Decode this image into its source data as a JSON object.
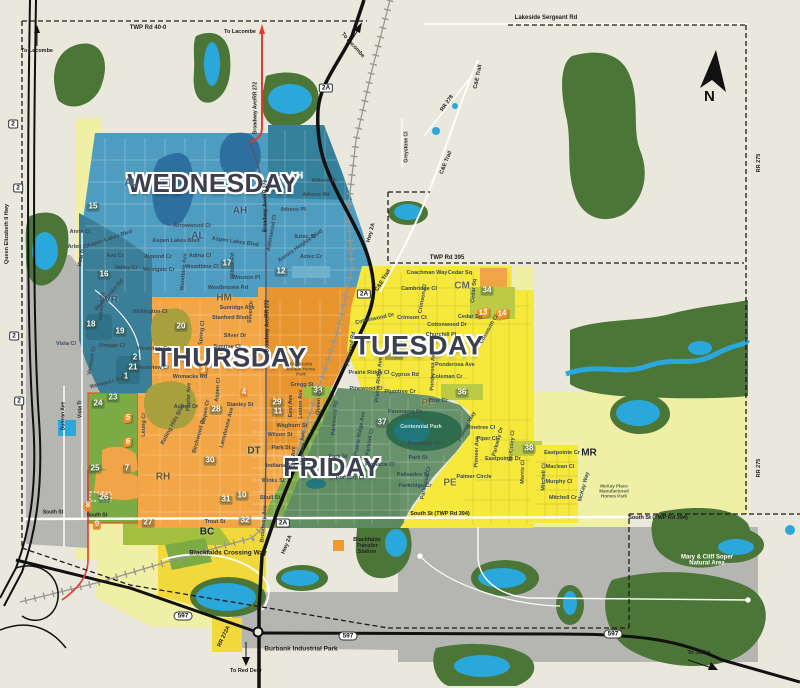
{
  "colors": {
    "wednesday": "#4F9CC1",
    "thursday": "#F2A646",
    "tuesday": "#F6E93C",
    "friday": "#5E8B63",
    "water": "#2AA7DB",
    "forest": "#4C7637",
    "industrial": "#B5B5B1",
    "residential": "#7CAB45",
    "pale": "#EFEFA6",
    "highway_red": "#E03C31"
  },
  "compass": {
    "letter": "N"
  },
  "labels": {
    "days": [
      {
        "t": "WEDNESDAY",
        "x": 213,
        "y": 183,
        "fs": 26
      },
      {
        "t": "THURSDAY",
        "x": 231,
        "y": 358,
        "fs": 27
      },
      {
        "t": "TUESDAY",
        "x": 419,
        "y": 346,
        "fs": 27
      },
      {
        "t": "FRIDAY",
        "x": 332,
        "y": 467,
        "fs": 26
      }
    ],
    "zones": [
      {
        "t": "AL",
        "x": 131,
        "y": 184
      },
      {
        "t": "AH",
        "x": 296,
        "y": 177,
        "c": "#FFFFFF"
      },
      {
        "t": "AH",
        "x": 240,
        "y": 212
      },
      {
        "t": "AL",
        "x": 198,
        "y": 237
      },
      {
        "t": "VR",
        "x": 111,
        "y": 301
      },
      {
        "t": "HM",
        "x": 224,
        "y": 299,
        "c": "#6E5623"
      },
      {
        "t": "DT",
        "x": 254,
        "y": 452,
        "c": "#2E4A33"
      },
      {
        "t": "RH",
        "x": 163,
        "y": 478,
        "c": "#6E5623"
      },
      {
        "t": "BC",
        "x": 207,
        "y": 533,
        "c": "#222222"
      },
      {
        "t": "CM",
        "x": 462,
        "y": 287,
        "c": "#66675B"
      },
      {
        "t": "PE",
        "x": 428,
        "y": 404,
        "c": "#74702F"
      },
      {
        "t": "PE",
        "x": 450,
        "y": 484,
        "c": "#74702F"
      },
      {
        "t": "MR",
        "x": 589,
        "y": 454,
        "c": "#222222"
      }
    ],
    "badges": [
      {
        "t": "15",
        "x": 93,
        "y": 207
      },
      {
        "t": "16",
        "x": 104,
        "y": 275
      },
      {
        "t": "17",
        "x": 227,
        "y": 264
      },
      {
        "t": "12",
        "x": 281,
        "y": 272
      },
      {
        "t": "18",
        "x": 91,
        "y": 325
      },
      {
        "t": "19",
        "x": 120,
        "y": 332
      },
      {
        "t": "20",
        "x": 181,
        "y": 327
      },
      {
        "t": "2",
        "x": 135,
        "y": 358
      },
      {
        "t": "21",
        "x": 133,
        "y": 368
      },
      {
        "t": "1",
        "x": 126,
        "y": 377
      },
      {
        "t": "23",
        "x": 113,
        "y": 398
      },
      {
        "t": "24",
        "x": 98,
        "y": 404
      },
      {
        "t": "25",
        "x": 95,
        "y": 469
      },
      {
        "t": "7",
        "x": 127,
        "y": 469
      },
      {
        "t": "26",
        "x": 104,
        "y": 498
      },
      {
        "t": "8",
        "x": 88,
        "y": 506,
        "v": "orange"
      },
      {
        "t": "9",
        "x": 97,
        "y": 525,
        "v": "orange"
      },
      {
        "t": "27",
        "x": 148,
        "y": 523
      },
      {
        "t": "28",
        "x": 216,
        "y": 410
      },
      {
        "t": "30",
        "x": 210,
        "y": 461
      },
      {
        "t": "31",
        "x": 226,
        "y": 500
      },
      {
        "t": "10",
        "x": 242,
        "y": 496
      },
      {
        "t": "32",
        "x": 245,
        "y": 521
      },
      {
        "t": "29",
        "x": 277,
        "y": 403
      },
      {
        "t": "11",
        "x": 278,
        "y": 412
      },
      {
        "t": "33",
        "x": 318,
        "y": 391
      },
      {
        "t": "4",
        "x": 244,
        "y": 393,
        "v": "orange"
      },
      {
        "t": "34",
        "x": 487,
        "y": 291
      },
      {
        "t": "36",
        "x": 462,
        "y": 393
      },
      {
        "t": "37",
        "x": 382,
        "y": 423
      },
      {
        "t": "38",
        "x": 529,
        "y": 449
      }
    ],
    "markers": [
      {
        "t": "3",
        "x": 203,
        "y": 370,
        "r": -10
      },
      {
        "t": "5",
        "x": 128,
        "y": 418,
        "r": -10
      },
      {
        "t": "6",
        "x": 128,
        "y": 442,
        "r": -10
      },
      {
        "t": "13",
        "x": 483,
        "y": 313,
        "r": -10
      },
      {
        "t": "14",
        "x": 502,
        "y": 314,
        "r": -10
      }
    ],
    "shields": [
      {
        "t": "2",
        "x": 13,
        "y": 124
      },
      {
        "t": "2",
        "x": 18,
        "y": 188
      },
      {
        "t": "2",
        "x": 14,
        "y": 336
      },
      {
        "t": "2",
        "x": 19,
        "y": 401
      },
      {
        "t": "2A",
        "x": 326,
        "y": 88
      },
      {
        "t": "2A",
        "x": 364,
        "y": 294
      },
      {
        "t": "2A",
        "x": 283,
        "y": 523
      },
      {
        "t": "597",
        "x": 183,
        "y": 616
      },
      {
        "t": "597",
        "x": 348,
        "y": 636
      },
      {
        "t": "597",
        "x": 613,
        "y": 634
      }
    ],
    "roads": [
      {
        "t": "TWP Rd 40-0",
        "x": 148,
        "y": 28
      },
      {
        "t": "Lakeside Sergeant Rd",
        "x": 546,
        "y": 18
      },
      {
        "t": "TWP Rd 395",
        "x": 447,
        "y": 258
      },
      {
        "t": "To Lacombe",
        "x": 37,
        "y": 52,
        "fs": 5.5
      },
      {
        "t": "To Lacombe",
        "x": 240,
        "y": 33,
        "fs": 5.5
      },
      {
        "t": "To Lacombe",
        "x": 352,
        "y": 46,
        "r": 48,
        "fs": 5.5
      },
      {
        "t": "To Red Deer",
        "x": 246,
        "y": 672,
        "fs": 5.5
      },
      {
        "t": "To Joffre",
        "x": 699,
        "y": 654,
        "fs": 5.5
      },
      {
        "t": "South St",
        "x": 53,
        "y": 513,
        "fs": 5
      },
      {
        "t": "South St",
        "x": 97,
        "y": 516,
        "fs": 5
      },
      {
        "t": "South St (TWP Rd 394)",
        "x": 440,
        "y": 515,
        "fs": 5.5
      },
      {
        "t": "South St (TWP Rd 394)",
        "x": 658,
        "y": 519,
        "fs": 5.5
      },
      {
        "t": "RR 275",
        "x": 760,
        "y": 163,
        "r": -90,
        "fs": 5.5
      },
      {
        "t": "RR 275",
        "x": 760,
        "y": 468,
        "r": -90,
        "fs": 5.5
      },
      {
        "t": "RR 278",
        "x": 448,
        "y": 104,
        "r": -55,
        "fs": 5.5
      },
      {
        "t": "C&E Trail",
        "x": 479,
        "y": 77,
        "r": -78,
        "fs": 5.5
      },
      {
        "t": "C&E Trail",
        "x": 447,
        "y": 163,
        "r": -68,
        "fs": 5.5
      },
      {
        "t": "C&E Trail",
        "x": 384,
        "y": 281,
        "r": -58,
        "fs": 5.5
      },
      {
        "t": "Greystone Cl",
        "x": 407,
        "y": 147,
        "r": -90,
        "fs": 5
      },
      {
        "t": "Queen Elizabeth II Hwy",
        "x": 8,
        "y": 234,
        "r": -90,
        "fs": 5.5
      },
      {
        "t": "Broadway Ave/RR 272",
        "x": 256,
        "y": 108,
        "r": -90,
        "fs": 5
      },
      {
        "t": "Broadway Ave/RR 272",
        "x": 266,
        "y": 206,
        "r": -90,
        "fs": 5
      },
      {
        "t": "Broadway Ave/RR 272",
        "x": 268,
        "y": 326,
        "r": -90,
        "fs": 5
      },
      {
        "t": "Hwy 2A",
        "x": 372,
        "y": 233,
        "r": -75,
        "fs": 5.5
      },
      {
        "t": "Hwy 2A",
        "x": 288,
        "y": 545,
        "r": -68,
        "fs": 5.5
      },
      {
        "t": "RR 272A",
        "x": 225,
        "y": 637,
        "r": -65,
        "fs": 5.5
      },
      {
        "t": "Duncan Ave",
        "x": 64,
        "y": 416,
        "r": -90,
        "fs": 5
      },
      {
        "t": "Vista Tr",
        "x": 82,
        "y": 258,
        "r": -80,
        "fs": 5
      },
      {
        "t": "Vista Tr",
        "x": 81,
        "y": 409,
        "r": -90,
        "fs": 5
      }
    ],
    "streets": [
      {
        "t": "Anna Cl",
        "x": 80,
        "y": 233
      },
      {
        "t": "Arlen Cl",
        "x": 78,
        "y": 248
      },
      {
        "t": "Ava Cr",
        "x": 115,
        "y": 257
      },
      {
        "t": "Aspen Lakes Blvd",
        "x": 110,
        "y": 240,
        "r": -18
      },
      {
        "t": "Aspen Lakes Blvd",
        "x": 176,
        "y": 242
      },
      {
        "t": "Aspen Lakes Blvd",
        "x": 235,
        "y": 243,
        "r": 8
      },
      {
        "t": "Valley Cr",
        "x": 126,
        "y": 269
      },
      {
        "t": "Westgate Cr",
        "x": 159,
        "y": 271
      },
      {
        "t": "Almond Cr",
        "x": 158,
        "y": 258
      },
      {
        "t": "Woodbine Ave",
        "x": 185,
        "y": 272,
        "r": -85
      },
      {
        "t": "Adina Cl",
        "x": 200,
        "y": 257
      },
      {
        "t": "Woodbine Cl",
        "x": 202,
        "y": 268
      },
      {
        "t": "Arrowwood Cl",
        "x": 192,
        "y": 227
      },
      {
        "t": "Willow Rd",
        "x": 234,
        "y": 266,
        "r": -90
      },
      {
        "t": "Winston Pl",
        "x": 246,
        "y": 279
      },
      {
        "t": "Westbrooke Rd",
        "x": 228,
        "y": 289
      },
      {
        "t": "Westbrooke Rd",
        "x": 110,
        "y": 296,
        "r": -48
      },
      {
        "t": "Athens Pl",
        "x": 324,
        "y": 182
      },
      {
        "t": "Athens Rd",
        "x": 316,
        "y": 196
      },
      {
        "t": "Athens Pl",
        "x": 293,
        "y": 211
      },
      {
        "t": "Aztec St",
        "x": 305,
        "y": 238
      },
      {
        "t": "Aztec Cr",
        "x": 311,
        "y": 258
      },
      {
        "t": "Aurora Heights Blvd",
        "x": 301,
        "y": 247,
        "r": -35
      },
      {
        "t": "Aldenwood Cl",
        "x": 273,
        "y": 233,
        "r": -80
      },
      {
        "t": "Valmont St",
        "x": 103,
        "y": 307,
        "r": -85
      },
      {
        "t": "Vista Cl",
        "x": 66,
        "y": 345
      },
      {
        "t": "Vintage Cl",
        "x": 112,
        "y": 347
      },
      {
        "t": "Vermont Cl",
        "x": 93,
        "y": 361,
        "r": -80
      },
      {
        "t": "Womacks Rd",
        "x": 107,
        "y": 384,
        "r": -15
      },
      {
        "t": "Sunridge Ave",
        "x": 237,
        "y": 309
      },
      {
        "t": "Stanford Blvd",
        "x": 230,
        "y": 319
      },
      {
        "t": "Silver Dr",
        "x": 235,
        "y": 337
      },
      {
        "t": "Silver Dr",
        "x": 252,
        "y": 312,
        "r": -85
      },
      {
        "t": "Sunrise Cl",
        "x": 227,
        "y": 348
      },
      {
        "t": "Spring Cl",
        "x": 203,
        "y": 333,
        "r": -85
      },
      {
        "t": "Wellington Cl",
        "x": 150,
        "y": 313
      },
      {
        "t": "Westview Cr",
        "x": 153,
        "y": 350
      },
      {
        "t": "Westview Cr",
        "x": 153,
        "y": 369
      },
      {
        "t": "Womacks Rd",
        "x": 190,
        "y": 378
      },
      {
        "t": "Poplar Ave",
        "x": 190,
        "y": 397,
        "r": -88
      },
      {
        "t": "Aspen Dr",
        "x": 186,
        "y": 408
      },
      {
        "t": "Aspen Cl",
        "x": 219,
        "y": 390,
        "r": -85
      },
      {
        "t": "Aspen Cr",
        "x": 207,
        "y": 412,
        "r": -80
      },
      {
        "t": "Stanley St",
        "x": 240,
        "y": 406
      },
      {
        "t": "Lansdowne Ave",
        "x": 228,
        "y": 428,
        "r": -75
      },
      {
        "t": "Leung Cl",
        "x": 145,
        "y": 425,
        "r": -88
      },
      {
        "t": "Rolling Hills Blvd",
        "x": 174,
        "y": 425,
        "r": -62
      },
      {
        "t": "Birchwood Dr",
        "x": 200,
        "y": 436,
        "r": -75
      },
      {
        "t": "Gregg St",
        "x": 302,
        "y": 386
      },
      {
        "t": "Waghorn St",
        "x": 292,
        "y": 427
      },
      {
        "t": "Wilson St",
        "x": 280,
        "y": 436
      },
      {
        "t": "Park St",
        "x": 281,
        "y": 449
      },
      {
        "t": "Indiana St",
        "x": 279,
        "y": 467
      },
      {
        "t": "Winks St",
        "x": 273,
        "y": 482
      },
      {
        "t": "Shull St",
        "x": 270,
        "y": 499
      },
      {
        "t": "East Ave",
        "x": 292,
        "y": 406,
        "r": -90
      },
      {
        "t": "Leston Ave",
        "x": 302,
        "y": 404,
        "r": -90
      },
      {
        "t": "Queen Cl",
        "x": 320,
        "y": 403,
        "r": -85
      },
      {
        "t": "Highway Ave",
        "x": 304,
        "y": 448,
        "r": -88
      },
      {
        "t": "East Ave",
        "x": 295,
        "y": 458,
        "r": -90
      },
      {
        "t": "Broadway Ave",
        "x": 265,
        "y": 524,
        "r": -85
      },
      {
        "t": "Trout St",
        "x": 215,
        "y": 523
      },
      {
        "t": "Parkwood Rd",
        "x": 336,
        "y": 418,
        "r": -85
      },
      {
        "t": "Prairie Ridge Ave",
        "x": 361,
        "y": 434,
        "r": -80
      },
      {
        "t": "Parkhill Cr",
        "x": 371,
        "y": 442,
        "r": -80
      },
      {
        "t": "Park St",
        "x": 338,
        "y": 458
      },
      {
        "t": "Park St",
        "x": 418,
        "y": 459
      },
      {
        "t": "Panorama Dr",
        "x": 405,
        "y": 413
      },
      {
        "t": "Pondside Cr",
        "x": 424,
        "y": 445
      },
      {
        "t": "Palisades St",
        "x": 413,
        "y": 476
      },
      {
        "t": "Parkridge Cr",
        "x": 415,
        "y": 487
      },
      {
        "t": "Pinnacle Cl",
        "x": 380,
        "y": 466
      },
      {
        "t": "Portway Cl",
        "x": 350,
        "y": 479
      },
      {
        "t": "Parkwood Cr",
        "x": 427,
        "y": 483,
        "r": -78
      },
      {
        "t": "Coachman Way",
        "x": 427,
        "y": 274
      },
      {
        "t": "Cedar Sq",
        "x": 460,
        "y": 274
      },
      {
        "t": "Cedar Sq",
        "x": 470,
        "y": 318
      },
      {
        "t": "Cedar Sq",
        "x": 475,
        "y": 291,
        "r": -85
      },
      {
        "t": "Cambridge Cl",
        "x": 419,
        "y": 290
      },
      {
        "t": "Crimson Cl",
        "x": 424,
        "y": 299,
        "r": -80
      },
      {
        "t": "Crimson Ct",
        "x": 412,
        "y": 319
      },
      {
        "t": "Cottonwood Dr",
        "x": 375,
        "y": 320,
        "r": -12
      },
      {
        "t": "Cottonwood Dr",
        "x": 447,
        "y": 326
      },
      {
        "t": "Churchill Pl",
        "x": 441,
        "y": 336
      },
      {
        "t": "Cosworth Cl",
        "x": 490,
        "y": 330,
        "r": -60
      },
      {
        "t": "Ponderosa Ave",
        "x": 434,
        "y": 371,
        "r": -88
      },
      {
        "t": "Ponderosa Ave",
        "x": 455,
        "y": 366
      },
      {
        "t": "Cyprus Rd",
        "x": 405,
        "y": 376
      },
      {
        "t": "Plumtree Cr",
        "x": 400,
        "y": 393
      },
      {
        "t": "Prairie Ridge Ave",
        "x": 380,
        "y": 380,
        "r": -85
      },
      {
        "t": "Prairie Ridge Cl",
        "x": 369,
        "y": 374
      },
      {
        "t": "Pinewood Cl",
        "x": 366,
        "y": 390
      },
      {
        "t": "Pinewood Rd",
        "x": 352,
        "y": 349,
        "r": -80
      },
      {
        "t": "Coleman Cr",
        "x": 447,
        "y": 378
      },
      {
        "t": "Pine Cr",
        "x": 438,
        "y": 402
      },
      {
        "t": "Pinetree Cl",
        "x": 481,
        "y": 429
      },
      {
        "t": "Piper Cl",
        "x": 487,
        "y": 440
      },
      {
        "t": "Pioneer Ave",
        "x": 478,
        "y": 452,
        "r": -88
      },
      {
        "t": "Parkway Dr",
        "x": 499,
        "y": 442,
        "r": -75
      },
      {
        "t": "Pioneer Way",
        "x": 468,
        "y": 427,
        "r": -62
      },
      {
        "t": "McKinley Cl",
        "x": 513,
        "y": 446,
        "r": -85
      },
      {
        "t": "Eastpointe Dr",
        "x": 503,
        "y": 460
      },
      {
        "t": "Palmer Circle",
        "x": 474,
        "y": 478
      },
      {
        "t": "Eastpointe Cr",
        "x": 562,
        "y": 454
      },
      {
        "t": "Maclean Cl",
        "x": 560,
        "y": 468
      },
      {
        "t": "Murphy Cl",
        "x": 559,
        "y": 483
      },
      {
        "t": "Mitchell Cr",
        "x": 563,
        "y": 499
      },
      {
        "t": "Mitchell Cl",
        "x": 545,
        "y": 477,
        "r": -88
      },
      {
        "t": "Morris Cl",
        "x": 524,
        "y": 472,
        "r": -88
      },
      {
        "t": "McKay Way",
        "x": 585,
        "y": 487,
        "r": -75
      }
    ],
    "places": [
      {
        "t": "Blackfalds Crossing Way",
        "x": 228,
        "y": 553,
        "fs": 6.5
      },
      {
        "t": "Blackfalds Transfer Station",
        "x": 367,
        "y": 547,
        "fs": 5.5,
        "w": 36
      },
      {
        "t": "Burbank Industrial Park",
        "x": 301,
        "y": 649,
        "fs": 6.5
      },
      {
        "t": "Mary & Cliff Soper Natural Area",
        "x": 707,
        "y": 561,
        "fs": 6,
        "c": "#FFFFFF",
        "w": 66
      },
      {
        "t": "Centennial Park",
        "x": 421,
        "y": 428,
        "fs": 5.5,
        "c": "#CFE3DC",
        "w": 42
      },
      {
        "t": "Blackfalds Mobile Home Park",
        "x": 301,
        "y": 370,
        "fs": 4.5,
        "c": "#6B5520",
        "w": 36
      },
      {
        "t": "McKay Place Manufactured Homes Park",
        "x": 614,
        "y": 492,
        "fs": 4.5,
        "c": "#55624E",
        "w": 42
      }
    ]
  }
}
